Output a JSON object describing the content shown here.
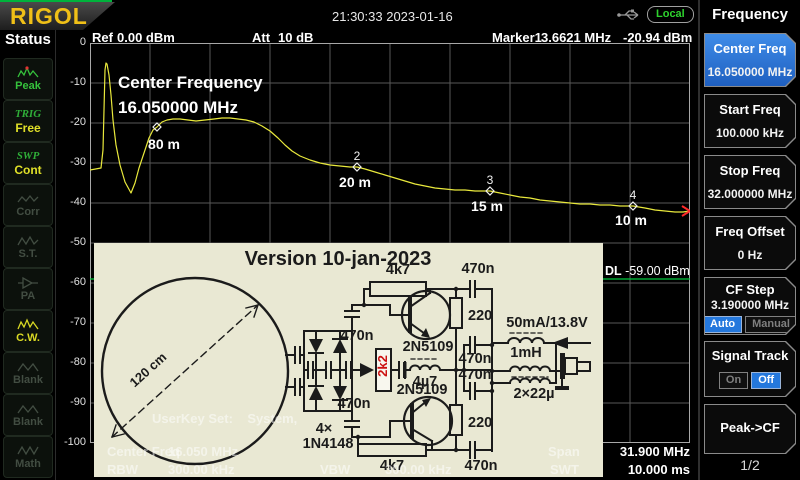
{
  "header": {
    "logo": "RIGOL",
    "time": "21:30:33 2023-01-16",
    "local": "Local"
  },
  "status": {
    "title": "Status",
    "items": [
      {
        "label": "Peak"
      },
      {
        "prefix": "TRIG",
        "label": "Free"
      },
      {
        "prefix": "SWP",
        "label": "Cont"
      },
      {
        "label": "Corr"
      },
      {
        "label": "S.T."
      },
      {
        "label": "PA"
      },
      {
        "label": "C.W."
      },
      {
        "label": "Blank"
      },
      {
        "label": "Blank"
      },
      {
        "label": "Math"
      }
    ]
  },
  "display": {
    "ref_label": "Ref",
    "ref_value": "0.00 dBm",
    "att_label": "Att",
    "att_value": "10 dB",
    "marker_label": "Marker1",
    "marker_freq": "3.6621 MHz",
    "marker_amp": "-20.94 dBm",
    "annotation_line1": "Center Frequency",
    "annotation_line2": "16.050000 MHz",
    "dl_label": "DL",
    "dl_value": "-59.00 dBm",
    "userkey": "UserKey Set:    System,"
  },
  "footer": {
    "cf_label": "Center Freq",
    "cf_value": "16.050 MHz",
    "rbw_label": "RBW",
    "rbw_value": "300.00 kHz",
    "vbw_label": "VBW",
    "vbw_value": "300.00 kHz",
    "span_label": "Span",
    "span_value": "31.900 MHz",
    "swt_label": "SWT",
    "swt_value": "10.000 ms"
  },
  "menu": {
    "title": "Frequency",
    "page": "1/2",
    "buttons": [
      {
        "label": "Center Freq",
        "value": "16.050000 MHz"
      },
      {
        "label": "Start Freq",
        "value": "100.000 kHz"
      },
      {
        "label": "Stop Freq",
        "value": "32.000000 MHz"
      },
      {
        "label": "Freq Offset",
        "value": "0 Hz"
      },
      {
        "label": "CF Step",
        "value": "3.190000 MHz",
        "options": [
          "Auto",
          "Manual"
        ],
        "selected": "Auto"
      },
      {
        "label": "Signal Track",
        "options": [
          "On",
          "Off"
        ],
        "selected": "Off"
      },
      {
        "label": "Peak->CF"
      }
    ]
  },
  "schematic": {
    "title": "Version 10-jan-2023",
    "loop_diameter": "120 cm",
    "diode_qty": "4×",
    "diode_type": "1N4148",
    "r_feedback_top": "4k7",
    "r_feedback_bottom": "4k7",
    "r_2k2": "2k2",
    "r_220_top": "220",
    "r_220_bottom": "220",
    "cap": "470n",
    "l_4u7": "4µ7",
    "l_1mh": "1mH",
    "l_22u": "2×22µ",
    "transistor": "2N5109",
    "supply": "50mA/13.8V"
  },
  "plot": {
    "grid": {
      "cols": 10,
      "rows": 10,
      "line_color": "#575757",
      "border_color": "#a8a8a8"
    },
    "y_ticks": [
      "0",
      "-10",
      "-20",
      "-30",
      "-40",
      "-50",
      "-60",
      "-70",
      "-80",
      "-90",
      "-100"
    ],
    "trace_color": "#e9e93c",
    "trace_points": [
      [
        0,
        127
      ],
      [
        11,
        125
      ],
      [
        13,
        107
      ],
      [
        15,
        27
      ],
      [
        16,
        20
      ],
      [
        17,
        21
      ],
      [
        19,
        32
      ],
      [
        21,
        52
      ],
      [
        23,
        77
      ],
      [
        26,
        102
      ],
      [
        30,
        122
      ],
      [
        35,
        139
      ],
      [
        41,
        150
      ],
      [
        45,
        140
      ],
      [
        49,
        125
      ],
      [
        54,
        110
      ],
      [
        59,
        95
      ],
      [
        63,
        87
      ],
      [
        67,
        84
      ],
      [
        72,
        79
      ],
      [
        77,
        77
      ],
      [
        83,
        76
      ],
      [
        90,
        76
      ],
      [
        98,
        77
      ],
      [
        106,
        78
      ],
      [
        115,
        77
      ],
      [
        124,
        76
      ],
      [
        132,
        75
      ],
      [
        140,
        75
      ],
      [
        148,
        76
      ],
      [
        156,
        77
      ],
      [
        164,
        79
      ],
      [
        172,
        83
      ],
      [
        180,
        88
      ],
      [
        188,
        95
      ],
      [
        195,
        102
      ],
      [
        202,
        108
      ],
      [
        210,
        113
      ],
      [
        220,
        117
      ],
      [
        230,
        120
      ],
      [
        240,
        122
      ],
      [
        250,
        123
      ],
      [
        260,
        124
      ],
      [
        267,
        124
      ],
      [
        275,
        126
      ],
      [
        285,
        129
      ],
      [
        295,
        132
      ],
      [
        305,
        135
      ],
      [
        315,
        138
      ],
      [
        325,
        141
      ],
      [
        335,
        143
      ],
      [
        345,
        145
      ],
      [
        355,
        146
      ],
      [
        365,
        147
      ],
      [
        375,
        147
      ],
      [
        385,
        148
      ],
      [
        392,
        148
      ],
      [
        400,
        148
      ],
      [
        410,
        150
      ],
      [
        420,
        152
      ],
      [
        430,
        154
      ],
      [
        440,
        155
      ],
      [
        450,
        157
      ],
      [
        460,
        158
      ],
      [
        470,
        159
      ],
      [
        480,
        160
      ],
      [
        490,
        161
      ],
      [
        500,
        161
      ],
      [
        510,
        162
      ],
      [
        520,
        162
      ],
      [
        530,
        163
      ],
      [
        543,
        163
      ],
      [
        555,
        165
      ],
      [
        565,
        167
      ],
      [
        575,
        168
      ],
      [
        585,
        169
      ],
      [
        593,
        169
      ],
      [
        600,
        168
      ]
    ],
    "markers": [
      {
        "label": "1",
        "x": 67,
        "y": 84,
        "show_label": false
      },
      {
        "label": "2",
        "x": 267,
        "y": 124,
        "show_label": true
      },
      {
        "label": "3",
        "x": 400,
        "y": 148,
        "show_label": true
      },
      {
        "label": "4",
        "x": 543,
        "y": 163,
        "show_label": true
      }
    ],
    "band_labels": [
      {
        "text": "80 m",
        "x": 74,
        "y": 106
      },
      {
        "text": "20 m",
        "x": 265,
        "y": 144
      },
      {
        "text": "15 m",
        "x": 397,
        "y": 168
      },
      {
        "text": "10 m",
        "x": 541,
        "y": 182
      }
    ],
    "display_line": {
      "y": 236,
      "color": "#00c83c"
    },
    "sweep_mark": {
      "x": 600,
      "y": 168,
      "color": "#ff2a2a"
    }
  }
}
